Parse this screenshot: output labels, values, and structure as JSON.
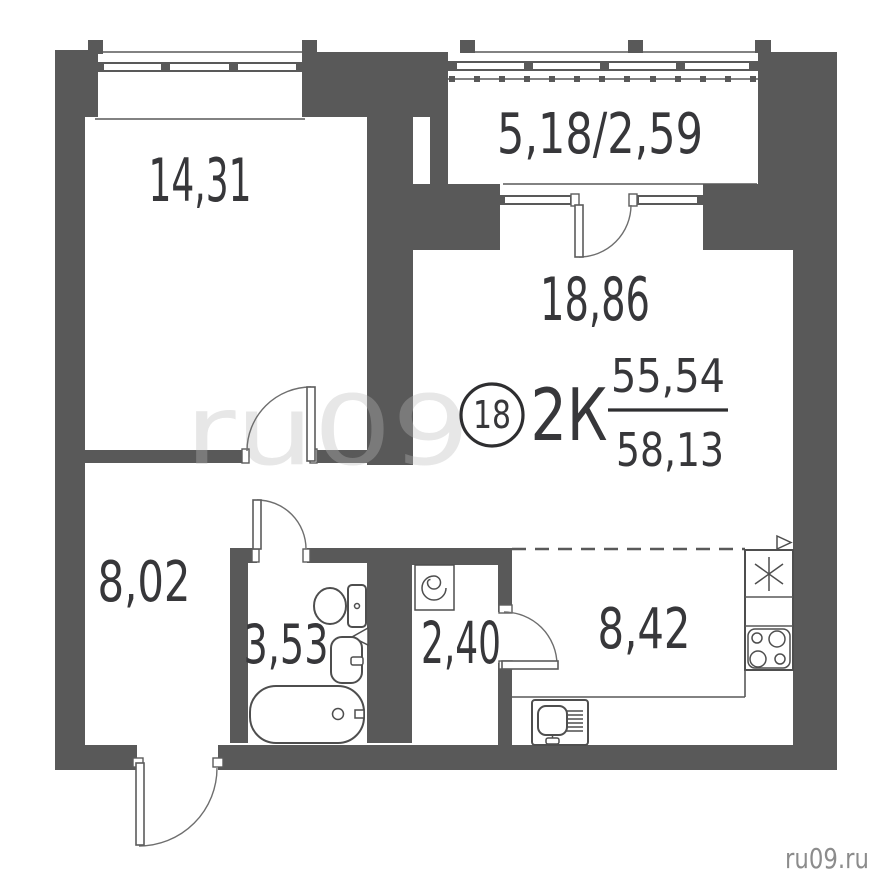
{
  "plan": {
    "apartment": {
      "number": "18",
      "type": "2К",
      "area_living": "55,54",
      "area_total": "58,13"
    },
    "rooms": {
      "bedroom": {
        "area": "14,31"
      },
      "living": {
        "area": "18,86"
      },
      "balcony": {
        "area": "5,18/2,59"
      },
      "hallway": {
        "area": "8,02"
      },
      "bathroom": {
        "area": "3,53"
      },
      "wardrobe": {
        "area": "2,40"
      },
      "kitchen": {
        "area": "8,42"
      }
    }
  },
  "watermark": {
    "center": "ru09",
    "corner": "ru09.ru"
  },
  "colors": {
    "wall": "#595959",
    "label": "#37373a",
    "line": "#4e4e4e",
    "wmcorner": "#8c8c8c"
  }
}
